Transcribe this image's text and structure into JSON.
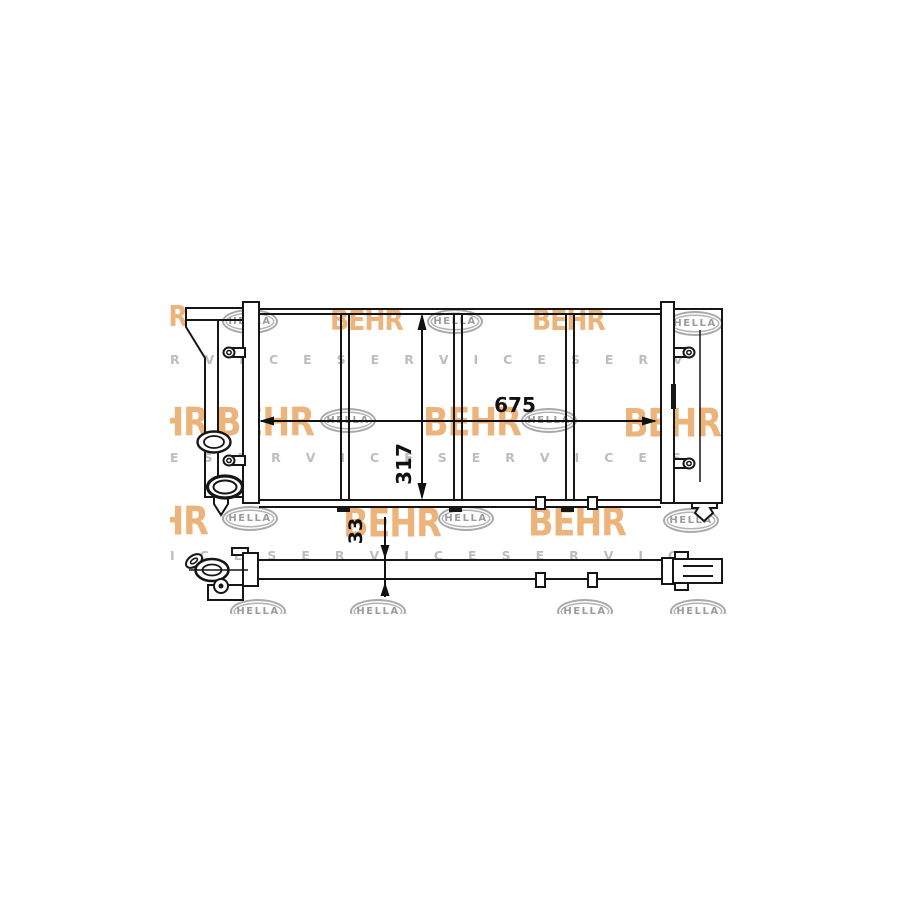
{
  "figure": {
    "dimensions": {
      "width": "675",
      "height": "317",
      "depth": "33"
    }
  },
  "watermarks": {
    "behr_label": "BEHR",
    "hella_label": "HELLA",
    "service_rows": [
      "RVICESERVICESERV",
      "ESERVICESERVICES",
      "ICESERVICESERVIC"
    ],
    "colors": {
      "behr_orange": "#e79e57",
      "hella_gray": "#a9a9a9",
      "service_gray": "#bdbdbd"
    },
    "items": [
      {
        "type": "hella",
        "x": 52,
        "y": 13
      },
      {
        "type": "behr-s",
        "x": 160,
        "y": 10
      },
      {
        "type": "hella",
        "x": 257,
        "y": 13
      },
      {
        "type": "behr-s",
        "x": 362,
        "y": 10
      },
      {
        "type": "hella",
        "x": 497,
        "y": 15
      },
      {
        "type": "behr-s",
        "x": -56,
        "y": 6
      },
      {
        "type": "service",
        "x": 0,
        "y": 58,
        "row": 0
      },
      {
        "type": "behr-l",
        "x": -60,
        "y": 108
      },
      {
        "type": "behr-l",
        "x": 46,
        "y": 108
      },
      {
        "type": "hella",
        "x": 150,
        "y": 112
      },
      {
        "type": "behr-l",
        "x": 253,
        "y": 108
      },
      {
        "type": "hella",
        "x": 351,
        "y": 112
      },
      {
        "type": "behr-l",
        "x": 453,
        "y": 109
      },
      {
        "type": "service",
        "x": 0,
        "y": 156,
        "row": 1
      },
      {
        "type": "behr-l",
        "x": -60,
        "y": 207
      },
      {
        "type": "hella",
        "x": 52,
        "y": 210
      },
      {
        "type": "behr-l",
        "x": 173,
        "y": 209
      },
      {
        "type": "hella",
        "x": 268,
        "y": 210
      },
      {
        "type": "behr-l",
        "x": 358,
        "y": 208
      },
      {
        "type": "hella",
        "x": 493,
        "y": 212
      },
      {
        "type": "service",
        "x": 0,
        "y": 254,
        "row": 2
      },
      {
        "type": "hella",
        "x": 60,
        "y": 303
      },
      {
        "type": "hella",
        "x": 180,
        "y": 303
      },
      {
        "type": "hella",
        "x": 387,
        "y": 303
      },
      {
        "type": "hella",
        "x": 500,
        "y": 303
      }
    ]
  }
}
